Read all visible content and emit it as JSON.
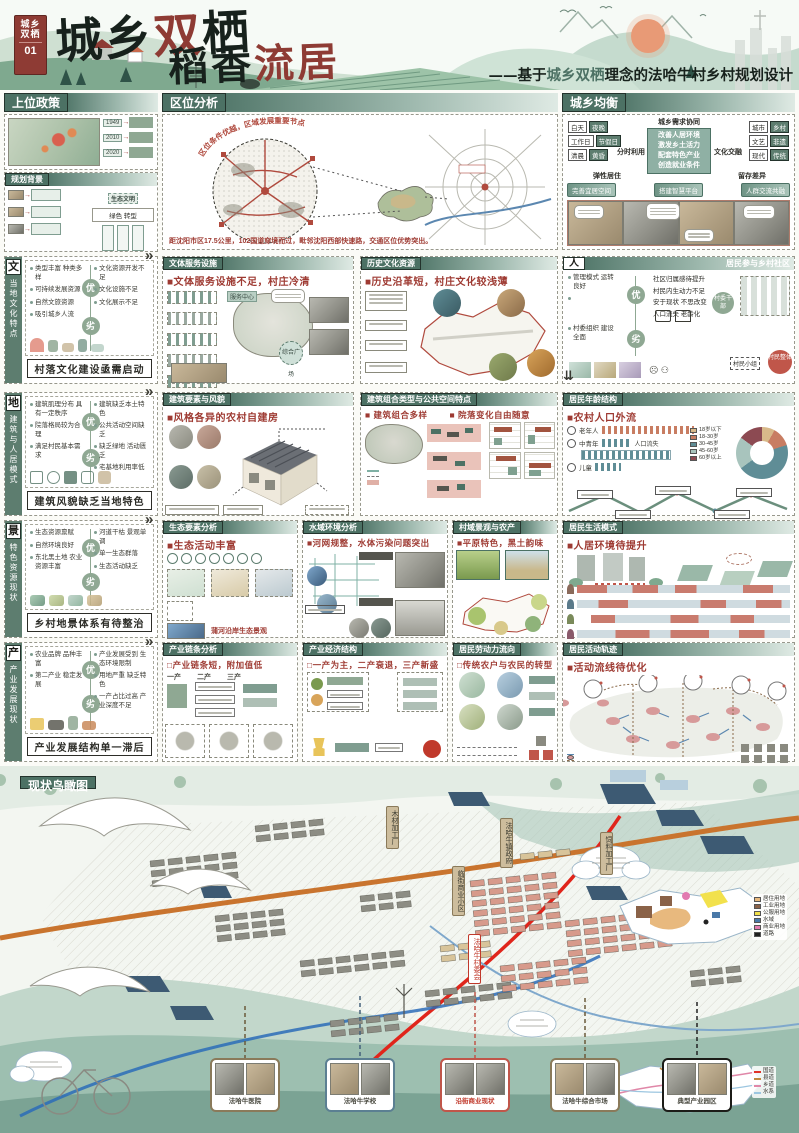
{
  "common": {
    "pro": "优",
    "con": "劣",
    "more": "»",
    "down": "⇊"
  },
  "poster": {
    "badge": {
      "line1": "城乡",
      "line2": "双栖",
      "num": "01"
    },
    "title1": {
      "c1": "城",
      "c2": "乡",
      "c3": "双",
      "c4": "栖"
    },
    "title2": {
      "black": "稻香",
      "red": "流居"
    },
    "subtitle": {
      "prefix": "——基于",
      "highlight": "城乡双栖",
      "rest": "理念的法哈牛村乡村规划设计"
    }
  },
  "sections": {
    "policy": {
      "title": "上位政策",
      "years": [
        "1949",
        "2010",
        "2020"
      ]
    },
    "background": {
      "title": "规划背景",
      "eco_label": "生态文明",
      "eco_note": "绿色 转型"
    },
    "location": {
      "title": "区位分析",
      "arc_note": "区位条件优越，区域发展重要节点",
      "caption": "距沈阳市区17.5公里，102国道穿境而过，毗邻沈阳西部快速路，交通区位优势突出。"
    },
    "balance": {
      "title": "城乡均衡",
      "center_title": "城乡需求协同",
      "center_items": [
        "改善人居环境",
        "激发乡土活力",
        "配套特色产业",
        "创造就业条件"
      ],
      "left_pairs": [
        [
          "白天",
          "夜晚"
        ],
        [
          "工作日",
          "节假日"
        ],
        [
          "清晨",
          "黄昏"
        ]
      ],
      "right_pairs": [
        [
          "城市",
          "乡村"
        ],
        [
          "文艺",
          "非遗"
        ],
        [
          "现代",
          "传统"
        ]
      ],
      "left_label": "分时利用",
      "right_label": "文化交融",
      "left_sub": "弹性居住",
      "right_sub": "留存差异",
      "pills": [
        "完善宜居空间",
        "搭建智慧平台",
        "人群交流共融"
      ]
    },
    "culture_tab": {
      "char": "文",
      "vertical": "当地文化特点",
      "banner": "村落文化建设亟需启动",
      "pros": [
        "类型丰富 种类多样",
        "可持续发展资源",
        "自然文旅资源",
        "吸引城乡人流"
      ],
      "cons": [
        "文化资源开发不足",
        "文化设施不足",
        "文化展示不足"
      ]
    },
    "facility": {
      "title": "文体服务设施",
      "headline": "■文体服务设施不足，村庄冷清",
      "note1": "服务中心",
      "note2": "综合广场"
    },
    "history": {
      "title": "历史文化资源",
      "headline": "■历史沿革短，村庄文化较浅薄"
    },
    "people": {
      "char": "人",
      "title": "居民参与乡村社区",
      "pros": [
        "管理模式 运转良好",
        "村委组织 建设全面"
      ],
      "cons": [
        "社区归属感待提升",
        "村民内生动力不足",
        "安于现状 不思改变",
        "人口流失 老龄化"
      ],
      "nodes": [
        "村委干部",
        "村民小组",
        "村民整体"
      ]
    },
    "arch_tab": {
      "char": "地",
      "vertical": "建筑与人居模式",
      "banner": "建筑风貌缺乏当地特色",
      "pros": [
        "建筑肌理分布 具有一定秩序",
        "院落格局较为合理",
        "满足村民基本需求"
      ],
      "cons": [
        "建筑缺乏本土特色",
        "公共活动空间缺乏",
        "缺乏绿地 活动匮乏",
        "宅基地利用率低"
      ]
    },
    "arch_style": {
      "title": "建筑要素与风貌",
      "headline": "■风格各异的农村自建房"
    },
    "arch_combo": {
      "title": "建筑组合类型与公共空间特点",
      "headline1": "■ 建筑组合多样",
      "headline2": "■ 院落变化自由随意"
    },
    "age": {
      "title": "居民年龄结构",
      "headline": "■农村人口外流",
      "groups": [
        "老年人",
        "中青年",
        "儿童"
      ],
      "loss_label": "人口流失",
      "donut": {
        "labels": [
          "18岁以下",
          "18-30岁",
          "30-45岁",
          "45-60岁",
          "60岁以上"
        ],
        "values": [
          8,
          12,
          45,
          20,
          15
        ],
        "colors": [
          "#d8b98a",
          "#c87d62",
          "#5f8d96",
          "#a8c4bd",
          "#8c4a52"
        ]
      }
    },
    "land_tab": {
      "char": "景",
      "vertical": "特色资源现状",
      "banner": "乡村地景体系有待整治",
      "pros": [
        "生态资源禀赋",
        "自然环境良好",
        "东北黑土地 农业资源丰富"
      ],
      "cons": [
        "河道干枯 景观单调",
        "单一生态群落",
        "生态活动缺乏"
      ]
    },
    "eco": {
      "title": "生态要素分析",
      "headline": "■生态活动丰富",
      "caption": "蒲河沿岸生态景观"
    },
    "water": {
      "title": "水域环境分析",
      "headline": "■河网规整，水体污染问题突出"
    },
    "village_view": {
      "title": "村域景观与农产",
      "headline": "■平原特色，黑土韵味"
    },
    "life": {
      "title": "居民生活模式",
      "headline": "■人居环境待提升"
    },
    "industry_tab": {
      "char": "产",
      "vertical": "产业发展现状",
      "banner": "产业发展结构单一滞后",
      "pros": [
        "农业品牌 品种丰富",
        "第二产业 稳定发展"
      ],
      "cons": [
        "产业发展受到 生态环境限制",
        "用地严重 缺乏特色",
        "一产占比过高 产业深度不足"
      ]
    },
    "chain": {
      "title": "产业链条分析",
      "headline": "□产业链条短，附加值低",
      "labels": [
        "一产",
        "二产",
        "三产"
      ]
    },
    "economy": {
      "title": "产业经济结构",
      "headline": "□一产为主，二产衰退，三产新盛"
    },
    "labor": {
      "title": "居民劳动力流向",
      "headline": "□传统农户与农民的转型"
    },
    "track": {
      "title": "居民活动轨迹",
      "headline": "■活动流线待优化"
    }
  },
  "aerial": {
    "title": "现状鸟瞰图",
    "tags": [
      "木材加工厂",
      "法哈牛镇政府",
      "饲料加工厂",
      "临街商业小区",
      "法哈牛村委会"
    ],
    "landuse_legend": [
      {
        "label": "居住用地",
        "color": "#e8b97e"
      },
      {
        "label": "工业用地",
        "color": "#8a6248"
      },
      {
        "label": "公服用地",
        "color": "#f2e14c"
      },
      {
        "label": "水域",
        "color": "#4a79a8"
      },
      {
        "label": "商业用地",
        "color": "#e27ab0"
      },
      {
        "label": "道路",
        "color": "#222222"
      }
    ],
    "road_legend": [
      {
        "label": "国道",
        "color": "#e03127"
      },
      {
        "label": "县道",
        "color": "#c08a3e"
      },
      {
        "label": "乡道",
        "color": "#e087a8"
      },
      {
        "label": "水系",
        "color": "#9cc6e0"
      }
    ],
    "photos": [
      "法哈牛医院",
      "法哈牛学校",
      "沿街商业现状",
      "法哈牛综合市场",
      "典型产业园区"
    ]
  }
}
